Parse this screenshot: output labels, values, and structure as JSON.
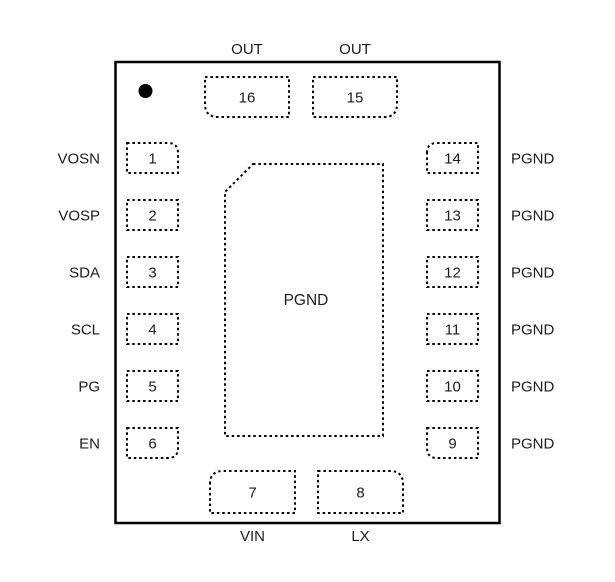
{
  "figure": {
    "type": "ic-package-pinout",
    "pin_count_visible": 16,
    "center_pad": {
      "label": "PGND"
    },
    "pin1_indicator": "filled-dot",
    "colors": {
      "line": "#000000",
      "text": "#1d1d1d",
      "background": "#ffffff"
    },
    "pins": [
      {
        "number": "1",
        "signal": "VOSN",
        "side": "left"
      },
      {
        "number": "2",
        "signal": "VOSP",
        "side": "left"
      },
      {
        "number": "3",
        "signal": "SDA",
        "side": "left"
      },
      {
        "number": "4",
        "signal": "SCL",
        "side": "left"
      },
      {
        "number": "5",
        "signal": "PG",
        "side": "left"
      },
      {
        "number": "6",
        "signal": "EN",
        "side": "left"
      },
      {
        "number": "7",
        "signal": "VIN",
        "side": "bottom"
      },
      {
        "number": "8",
        "signal": "LX",
        "side": "bottom"
      },
      {
        "number": "9",
        "signal": "PGND",
        "side": "right"
      },
      {
        "number": "10",
        "signal": "PGND",
        "side": "right"
      },
      {
        "number": "11",
        "signal": "PGND",
        "side": "right"
      },
      {
        "number": "12",
        "signal": "PGND",
        "side": "right"
      },
      {
        "number": "13",
        "signal": "PGND",
        "side": "right"
      },
      {
        "number": "14",
        "signal": "PGND",
        "side": "right"
      },
      {
        "number": "15",
        "signal": "OUT",
        "side": "top"
      },
      {
        "number": "16",
        "signal": "OUT",
        "side": "top"
      }
    ]
  }
}
